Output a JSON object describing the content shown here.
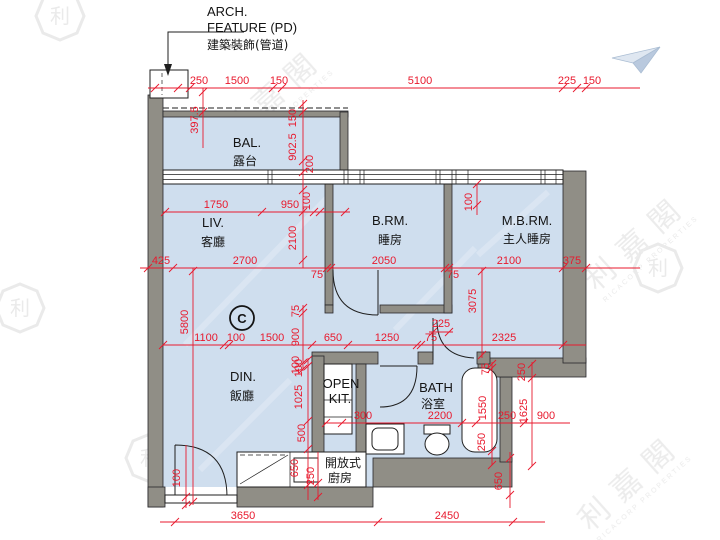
{
  "arch_feature": [
    "ARCH.",
    "FEATURE (PD)",
    "建築裝飾(管道)"
  ],
  "unit_label": "C",
  "rooms": {
    "bal": {
      "en": "BAL.",
      "zh": "露台"
    },
    "liv": {
      "en": "LIV.",
      "zh": "客廳"
    },
    "brm": {
      "en": "B.RM.",
      "zh": "睡房"
    },
    "mbrm": {
      "en": "M.B.RM.",
      "zh": "主人睡房"
    },
    "din": {
      "en": "DIN.",
      "zh": "飯廳"
    },
    "kit": {
      "en1": "OPEN",
      "en2": "KIT.",
      "zh1": "開放式",
      "zh2": "廚房"
    },
    "bath": {
      "en": "BATH",
      "zh": "浴室"
    }
  },
  "dims": {
    "top": [
      "250",
      "1500",
      "150",
      "5100",
      "225",
      "150"
    ],
    "v397": "397.5",
    "bal": [
      "150",
      "902.5",
      "200"
    ],
    "liv_top": [
      "1750",
      "950"
    ],
    "liv_col": [
      "100",
      "2100"
    ],
    "mbrm_top": "100",
    "mid": [
      "425",
      "2700",
      "75",
      "2050",
      "75",
      "2100",
      "375"
    ],
    "v3075": "3075",
    "v5800": "5800",
    "door": "225",
    "low": [
      "1100",
      "100",
      "1500",
      "650",
      "1250",
      "75",
      "2325"
    ],
    "corr": [
      "75",
      "900",
      "100"
    ],
    "din_col": [
      "100",
      "1025",
      "500"
    ],
    "kit_col": [
      "650",
      "250"
    ],
    "entry": "100",
    "bath_row": [
      "300",
      "2200",
      "250",
      "900"
    ],
    "tub_col": [
      "75",
      "1550",
      "250"
    ],
    "right_col": [
      "250",
      "1625"
    ],
    "v650": "650",
    "bottom": [
      "3650",
      "2450"
    ]
  },
  "watermark": {
    "logo_char": "利",
    "text": "利嘉閣",
    "subtext": "RICACORP PROPERTIES"
  },
  "colors": {
    "floor": "#cfdeee",
    "wall": "#908e86",
    "dimension": "#e8192d"
  }
}
